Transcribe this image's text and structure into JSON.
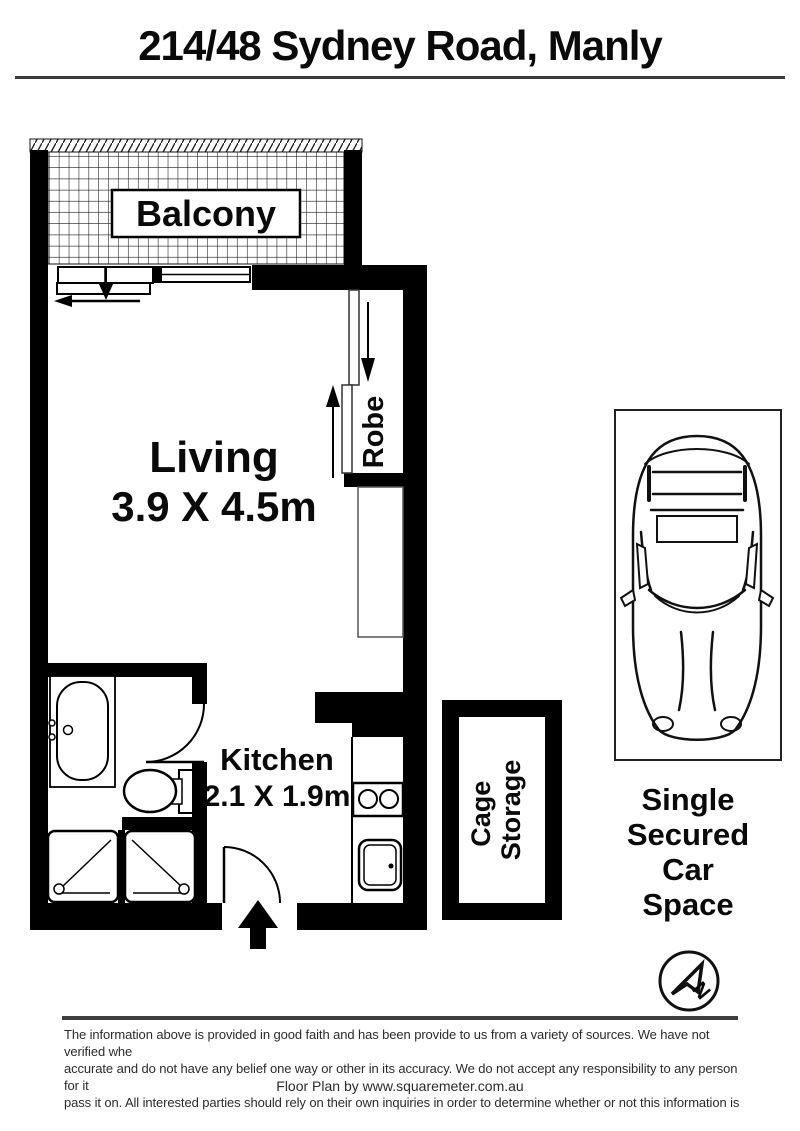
{
  "title": "214/48 Sydney Road, Manly",
  "plan": {
    "balcony": {
      "label": "Balcony"
    },
    "living": {
      "label": "Living",
      "dimensions": "3.9 X 4.5m"
    },
    "robe": {
      "label": "Robe"
    },
    "kitchen": {
      "label": "Kitchen",
      "dimensions": "2.1 X 1.9m"
    },
    "cage_storage": {
      "line1": "Cage",
      "line2": "Storage"
    },
    "car_space": {
      "line1": "Single",
      "line2": "Secured",
      "line3": "Car",
      "line4": "Space"
    },
    "compass": {
      "letter": "N"
    }
  },
  "footer": {
    "disclaimer_line1": "The information above is provided in good faith and has been provide to us from a variety of sources. We have not verified whe",
    "disclaimer_line2": "accurate and do not have any belief one way or other in its accuracy. We do not accept any responsibility to any person for it",
    "disclaimer_line3": "pass it on. All interested parties should rely on their own inquiries in order to determine whether or not this information is",
    "credit": "Floor Plan by www.squaremeter.com.au"
  },
  "colors": {
    "wall": "#000000",
    "rule": "#3a3a3a",
    "background": "#ffffff"
  }
}
